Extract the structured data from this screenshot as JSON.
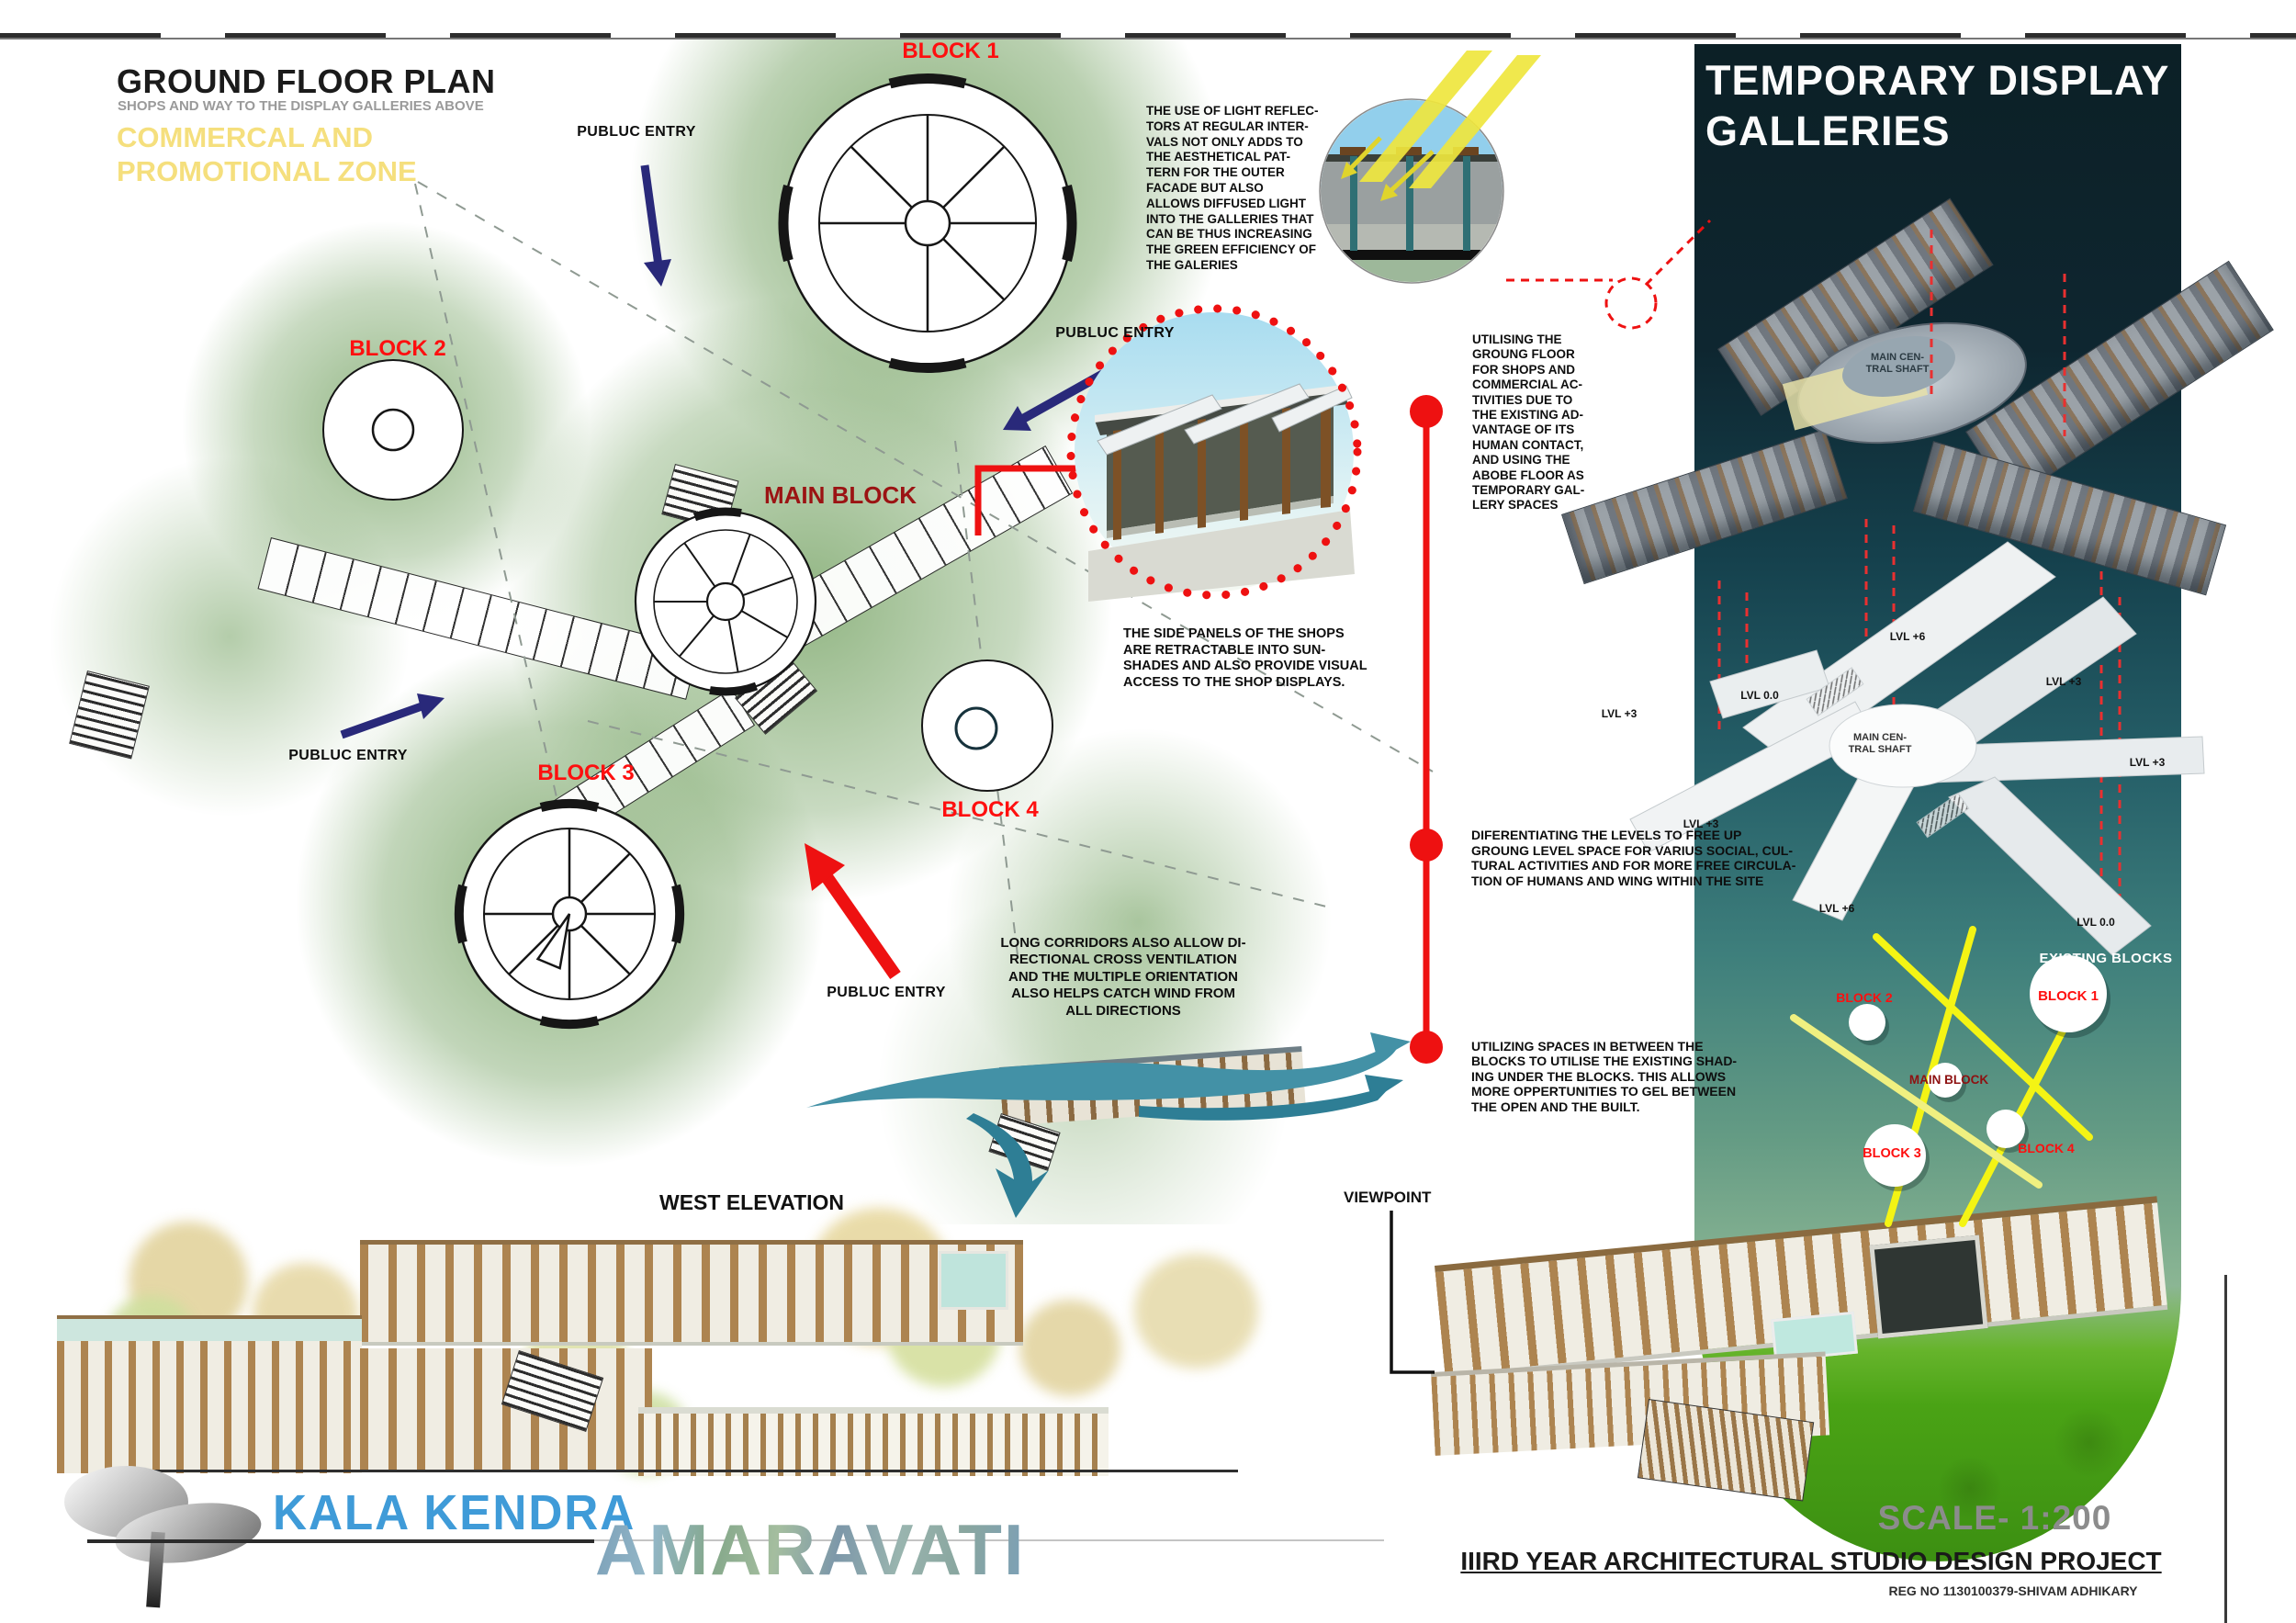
{
  "colors": {
    "accent_red": "#ee1111",
    "label_red": "#fe0f0f",
    "dark_red": "#8e1111",
    "navy_arrow": "#29297a",
    "zone_yellow": "#f5df7d",
    "panel_dark": "#0d2128",
    "teal_arrow": "#4391a6",
    "diagram_yellow": "#f4f414",
    "brand_blue": "#3f9bd8",
    "green_zone": "#7ba66a"
  },
  "header": {
    "title": "GROUND FLOOR PLAN",
    "subtitle": "SHOPS AND WAY TO THE DISPLAY GALLERIES ABOVE",
    "zone": "COMMERCAL AND\nPROMOTIONAL ZONE"
  },
  "plan": {
    "entry_label": "PUBLUC ENTRY",
    "blocks": {
      "block1": "BLOCK 1",
      "block2": "BLOCK 2",
      "block3": "BLOCK 3",
      "block4": "BLOCK 4",
      "main": "MAIN BLOCK"
    }
  },
  "notes": {
    "light_reflectors": "THE USE OF LIGHT REFLEC-\nTORS AT REGULAR INTER-\nVALS NOT ONLY ADDS TO\nTHE AESTHETICAL PAT-\nTERN FOR THE OUTER\nFACADE BUT ALSO\nALLOWS DIFFUSED LIGHT\nINTO THE GALLERIES THAT\nCAN BE THUS INCREASING\nTHE GREEN EFFICIENCY OF\nTHE GALERIES",
    "utilising_ground": "UTILISING THE\nGROUNG FLOOR\nFOR SHOPS AND\nCOMMERCIAL AC-\nTIVITIES DUE TO\nTHE EXISTING AD-\nVANTAGE OF ITS\nHUMAN CONTACT,\nAND USING THE\nABOBE FLOOR AS\nTEMPORARY GAL-\nLERY SPACES",
    "side_panels": "THE SIDE PANELS OF THE SHOPS\nARE RETRACTABLE INTO SUN-\nSHADES AND ALSO PROVIDE VISUAL\nACCESS TO THE SHOP DISPLAYS.",
    "differentiating": "DIFERENTIATING THE LEVELS TO FREE UP\nGROUNG LEVEL SPACE FOR  VARIUS SOCIAL, CUL-\nTURAL ACTIVITIES AND FOR MORE FREE CIRCULA-\nTION OF HUMANS AND WING WITHIN THE SITE",
    "long_corridors": "LONG CORRIDORS ALSO ALLOW DI-\nRECTIONAL CROSS VENTILATION\nAND THE  MULTIPLE ORIENTATION\nALSO HELPS CATCH WIND FROM\nALL DIRECTIONS",
    "utilizing_spaces": "UTILIZING SPACES IN BETWEEN THE\nBLOCKS TO UTILISE THE EXISTING SHAD-\nING UNDER THE BLOCKS. THIS ALLOWS\nMORE OPPERTUNITIES TO GEL BETWEEN\nTHE OPEN AND THE BUILT."
  },
  "right_panel": {
    "title": "TEMPORARY DISPLAY\nGALLERIES",
    "central_shaft": "MAIN CEN-\nTRAL SHAFT",
    "levels": [
      "LVL +6",
      "LVL +3",
      "LVL 0.0",
      "LVL +3",
      "LVL +3",
      "LVL +3",
      "LVL +6",
      "LVL 0.0"
    ],
    "diagram": {
      "existing": "EXISTING BLOCKS",
      "block1": "BLOCK 1",
      "block2": "BLOCK 2",
      "block3": "BLOCK 3",
      "block4": "BLOCK 4",
      "main": "MAIN BLOCK"
    }
  },
  "elevation": {
    "label": "WEST ELEVATION"
  },
  "viewpoint": {
    "label": "VIEWPOINT"
  },
  "footer": {
    "brand": "KALA KENDRA",
    "city": "AMARAVATI",
    "scale": "SCALE- 1:200",
    "project": "IIIRD YEAR ARCHITECTURAL STUDIO DESIGN PROJECT",
    "reg": "REG NO  1130100379-SHIVAM ADHIKARY"
  }
}
